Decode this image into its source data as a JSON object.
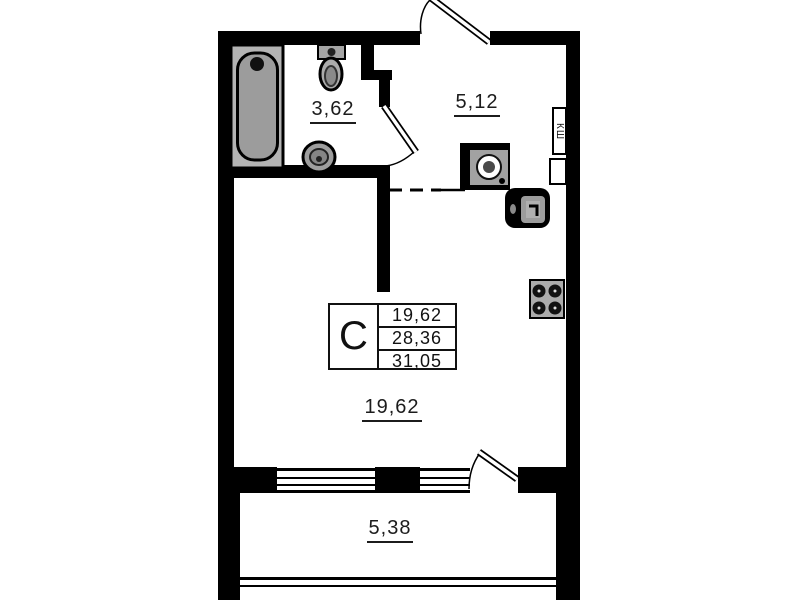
{
  "floorplan": {
    "rooms": {
      "bathroom": {
        "area": "3,62"
      },
      "hall": {
        "area": "5,12"
      },
      "living": {
        "area": "19,62"
      },
      "balcony": {
        "area": "5,38"
      }
    },
    "stamp": {
      "type": "C",
      "values": [
        "19,62",
        "28,36",
        "31,05"
      ]
    },
    "shaft": {
      "label": "КШ"
    },
    "colors": {
      "walls": "#000000",
      "fixtures": "#9c9c9c",
      "background": "#ffffff"
    }
  }
}
